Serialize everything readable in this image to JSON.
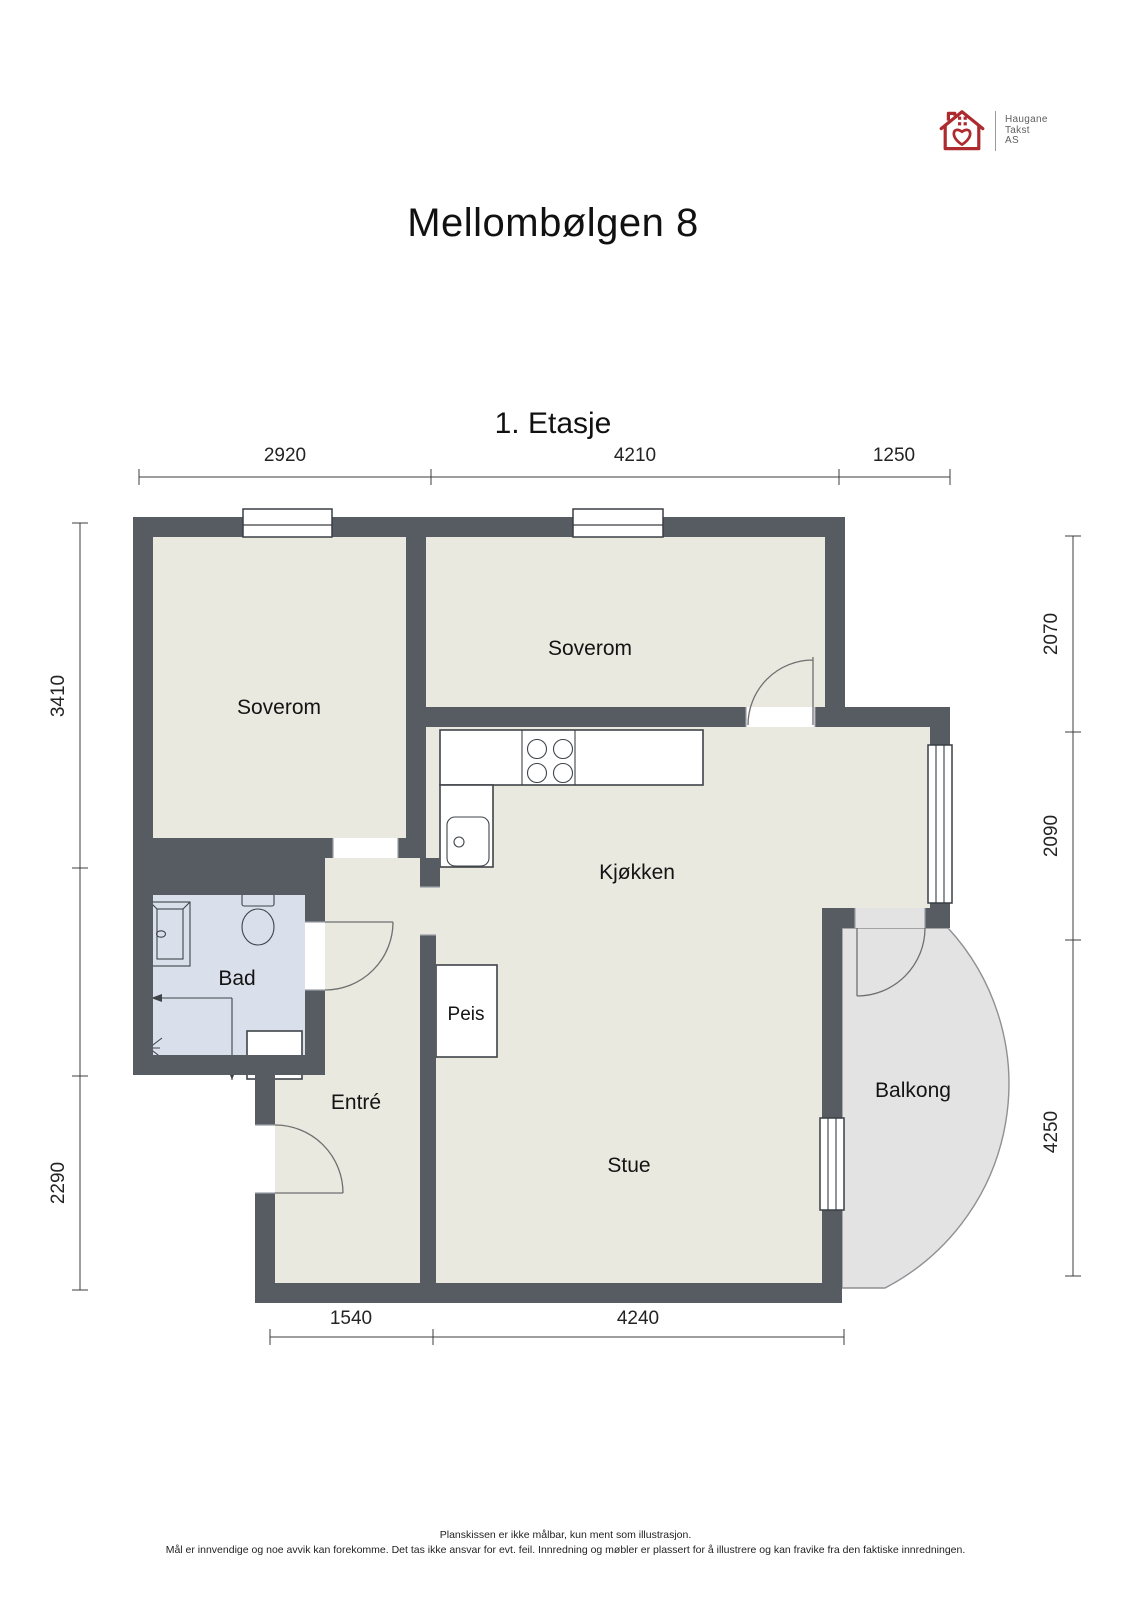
{
  "header": {
    "logo": {
      "lines": [
        "Haugane",
        "Takst",
        "AS"
      ]
    },
    "title": "Mellombølgen 8"
  },
  "plan": {
    "floor_title": "1. Etasje",
    "rooms": {
      "soverom_left": "Soverom",
      "soverom_top": "Soverom",
      "kjokken": "Kjøkken",
      "bad": "Bad",
      "entre": "Entré",
      "peis": "Peis",
      "stue": "Stue",
      "balkong": "Balkong"
    },
    "dimensions": {
      "top": [
        "2920",
        "4210",
        "1250"
      ],
      "bottom": [
        "1540",
        "4240"
      ],
      "left": [
        "3410",
        "2290"
      ],
      "right": [
        "2070",
        "2090",
        "4250"
      ]
    }
  },
  "footer": {
    "line1": "Planskissen er ikke målbar, kun ment som illustrasjon.",
    "line2": "Mål er innvendige og noe avvik kan forekomme. Det tas ikke ansvar for evt. feil. Innredning og møbler er plassert for å illustrere og kan fravike fra den faktiske innredningen."
  },
  "colors": {
    "wall": "#575c63",
    "floor": "#e9e9e0",
    "bathroom_floor": "#d9dfeb",
    "balcony_floor": "#e3e3e4",
    "logo_red": "#ad2a2e"
  }
}
